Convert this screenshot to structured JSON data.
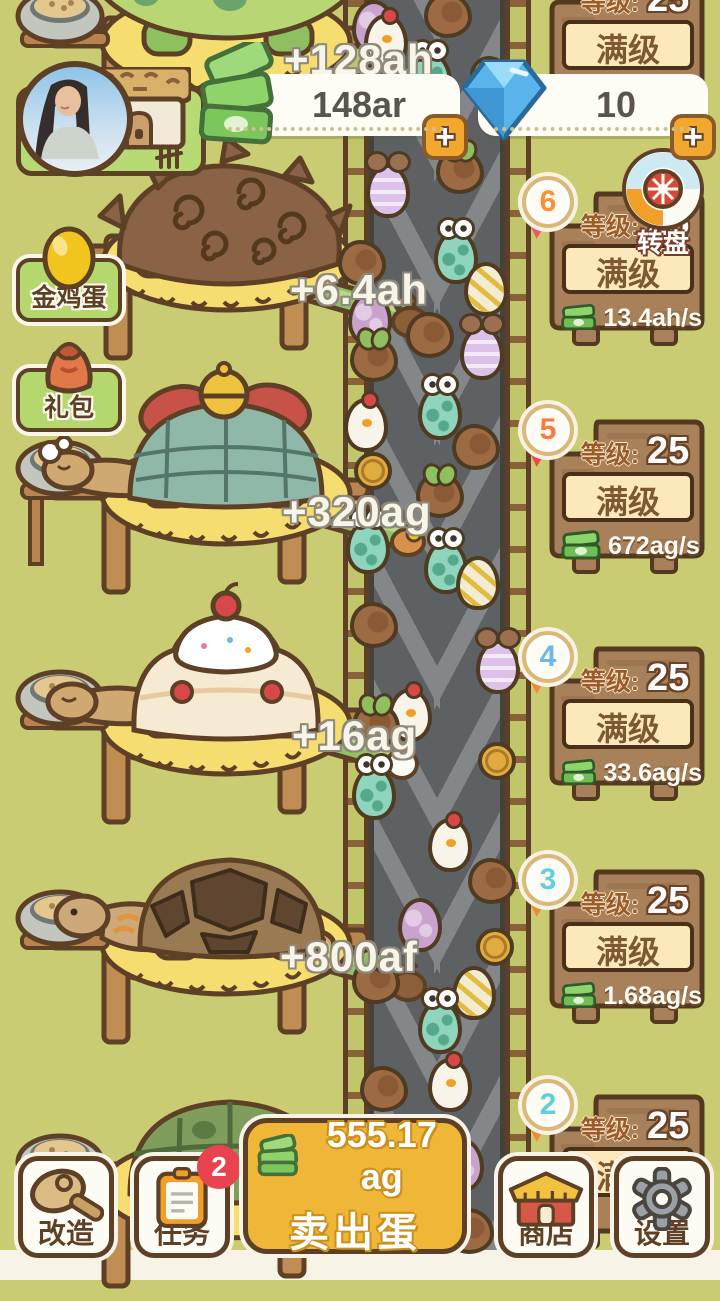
{
  "header": {
    "coins_value": "148ar",
    "coins_add": "+",
    "gems_value": "10",
    "gems_add": "+"
  },
  "top_panel": {
    "level_label": "等级:",
    "level": "25",
    "max": "满级"
  },
  "wheel": {
    "label": "转盘"
  },
  "side_buttons": {
    "golden_egg": "金鸡蛋",
    "gift": "礼包"
  },
  "income_popups": [
    "+128ah",
    "+6.4ah",
    "+320ag",
    "+16ag",
    "+800af"
  ],
  "panels": [
    {
      "badge": "6",
      "level_label": "等级:",
      "level": "25",
      "max": "满级",
      "rate": "13.4ah/s",
      "num_color": "#f5913a",
      "ribbon_color": "#e85a6a",
      "num_style": "color:#f5913a",
      "ribbon_style": "background:#e85a6a"
    },
    {
      "badge": "5",
      "level_label": "等级:",
      "level": "25",
      "max": "满级",
      "rate": "672ag/s",
      "num_color": "#f57a45",
      "ribbon_color": "#e84a4a",
      "num_style": "color:#f57a45",
      "ribbon_style": "background:#e84a4a"
    },
    {
      "badge": "4",
      "level_label": "等级:",
      "level": "25",
      "max": "满级",
      "rate": "33.6ag/s",
      "num_color": "#6cb9e9",
      "ribbon_color": "#f08838",
      "num_style": "color:#6cb9e9",
      "ribbon_style": "background:#f08838"
    },
    {
      "badge": "3",
      "level_label": "等级:",
      "level": "25",
      "max": "满级",
      "rate": "1.68ag/s",
      "num_color": "#5fcfe0",
      "ribbon_color": "#f08838",
      "num_style": "color:#5fcfe0",
      "ribbon_style": "background:#f08838"
    },
    {
      "badge": "2",
      "level_label": "等级:",
      "level": "25",
      "max": "满级",
      "rate": "",
      "num_color": "#5fcfe0",
      "ribbon_color": "#f08838",
      "num_style": "color:#5fcfe0",
      "ribbon_style": "background:#f08838"
    }
  ],
  "bottom_bar": {
    "remodel": "改造",
    "tasks": "任务",
    "tasks_badge": "2",
    "sell_amount": "555.17 ag",
    "sell_action": "卖出蛋",
    "shop": "商店",
    "settings": "设置"
  },
  "belt": {
    "eggs": [
      {
        "type": "plum",
        "x": 352,
        "y": 0
      },
      {
        "type": "choco",
        "x": 424,
        "y": -8
      },
      {
        "type": "chick",
        "x": 364,
        "y": 14
      },
      {
        "type": "teal",
        "x": 408,
        "y": 52
      },
      {
        "type": "coin",
        "x": 470,
        "y": 56
      },
      {
        "type": "purple",
        "x": 366,
        "y": 164
      },
      {
        "type": "chocoL",
        "x": 436,
        "y": 148
      },
      {
        "type": "teal",
        "x": 434,
        "y": 230
      },
      {
        "type": "cream",
        "x": 464,
        "y": 262
      },
      {
        "type": "choco",
        "x": 338,
        "y": 240
      },
      {
        "type": "plum",
        "x": 348,
        "y": 292
      },
      {
        "type": "chocoL",
        "x": 350,
        "y": 336
      },
      {
        "type": "choco",
        "x": 406,
        "y": 312
      },
      {
        "type": "purple",
        "x": 460,
        "y": 326
      },
      {
        "type": "teal",
        "x": 418,
        "y": 386
      },
      {
        "type": "chick",
        "x": 344,
        "y": 398
      },
      {
        "type": "choco",
        "x": 452,
        "y": 424
      },
      {
        "type": "coin",
        "x": 354,
        "y": 452
      },
      {
        "type": "chocoL",
        "x": 416,
        "y": 472
      },
      {
        "type": "teal",
        "x": 424,
        "y": 540
      },
      {
        "type": "cream",
        "x": 456,
        "y": 556
      },
      {
        "type": "teal",
        "x": 346,
        "y": 520
      },
      {
        "type": "choco",
        "x": 350,
        "y": 602
      },
      {
        "type": "purple",
        "x": 476,
        "y": 640
      },
      {
        "type": "chick",
        "x": 388,
        "y": 688
      },
      {
        "type": "chocoL",
        "x": 352,
        "y": 702
      },
      {
        "type": "coin",
        "x": 478,
        "y": 742
      },
      {
        "type": "teal",
        "x": 352,
        "y": 766
      },
      {
        "type": "chick",
        "x": 428,
        "y": 818
      },
      {
        "type": "choco",
        "x": 468,
        "y": 858
      },
      {
        "type": "plum",
        "x": 398,
        "y": 898
      },
      {
        "type": "coin",
        "x": 476,
        "y": 928
      },
      {
        "type": "chocoL",
        "x": 352,
        "y": 958
      },
      {
        "type": "cream",
        "x": 452,
        "y": 966
      },
      {
        "type": "teal",
        "x": 418,
        "y": 1000
      },
      {
        "type": "chick",
        "x": 428,
        "y": 1058
      },
      {
        "type": "choco",
        "x": 360,
        "y": 1066
      },
      {
        "type": "plum",
        "x": 440,
        "y": 1138
      },
      {
        "type": "choco",
        "x": 446,
        "y": 1208
      }
    ]
  }
}
